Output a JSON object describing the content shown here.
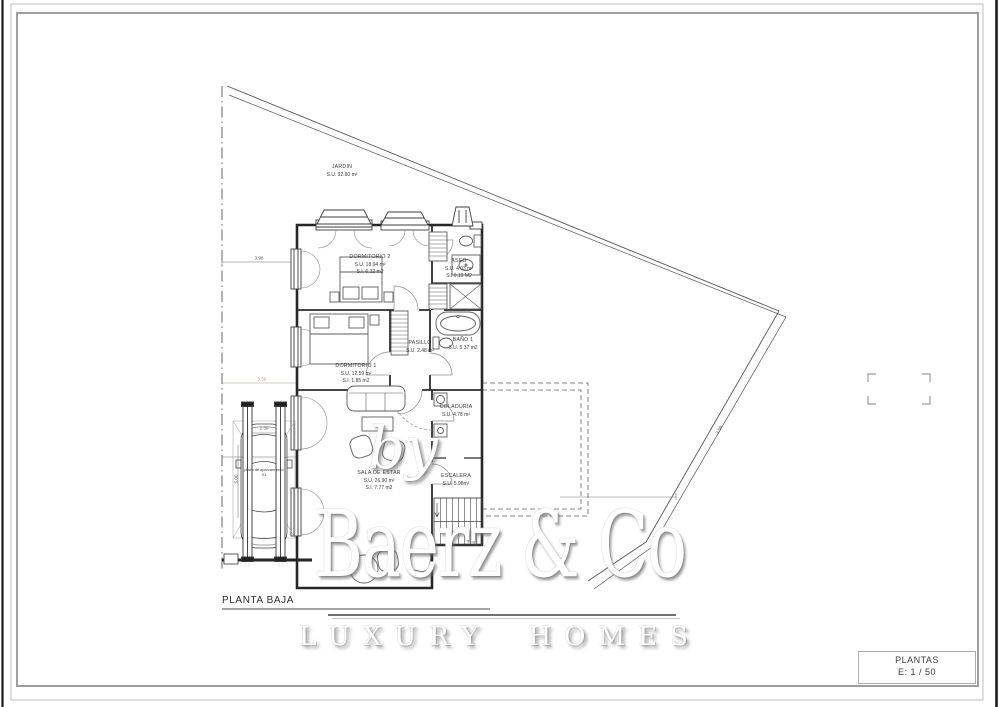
{
  "colors": {
    "paper": "#ffffff",
    "wall_ink": "#2f2f2f",
    "line_mid": "#666666",
    "frame_gray": "#a5a5a5",
    "dim_accent": "#bb9668",
    "photo_edge_black": "#1b1b1b"
  },
  "sheet": {
    "plan_title": "PLANTA BAJA",
    "title_block": {
      "line1": "PLANTAS",
      "line2": "E: 1 / 50"
    }
  },
  "watermark": {
    "by": "by",
    "brand": "Baerz & Co",
    "tagline": "LUXURY HOMES"
  },
  "rooms": [
    {
      "name": "JARDIN",
      "area": "S.U. 92.60 m²"
    },
    {
      "name": "DORMITORIO 2",
      "area": "S.U. 18.94 m²",
      "area2": "S.I. 6.32 m2"
    },
    {
      "name": "ASEO",
      "area": "S.U. 4.03 m²",
      "area2": "S.I 0.19 M2"
    },
    {
      "name": "BAÑO 1",
      "area": "S.U. 5.37 m2"
    },
    {
      "name": "PASILLO",
      "area": "S.U. 2.48 m²"
    },
    {
      "name": "DORMITORIO 1",
      "area": "S.U. 12.59 m²",
      "area2": "S.I. 1.85 m2"
    },
    {
      "name": "COLADURIA",
      "area": "S.U. 4.78 m²"
    },
    {
      "name": "SALA DE ESTAR",
      "area": "S.U. 26.90 m²",
      "area2": "S.I. 7.77 m2"
    },
    {
      "name": "ESCALERA",
      "area": "S.U. 5.98m²"
    },
    {
      "name": "plaza de aparcamiento",
      "area": "01"
    }
  ],
  "dimensions": [
    {
      "value": "3.98"
    },
    {
      "value": "3.50"
    },
    {
      "value": "2.30"
    },
    {
      "value": "5.00"
    },
    {
      "value": "3.58"
    }
  ]
}
